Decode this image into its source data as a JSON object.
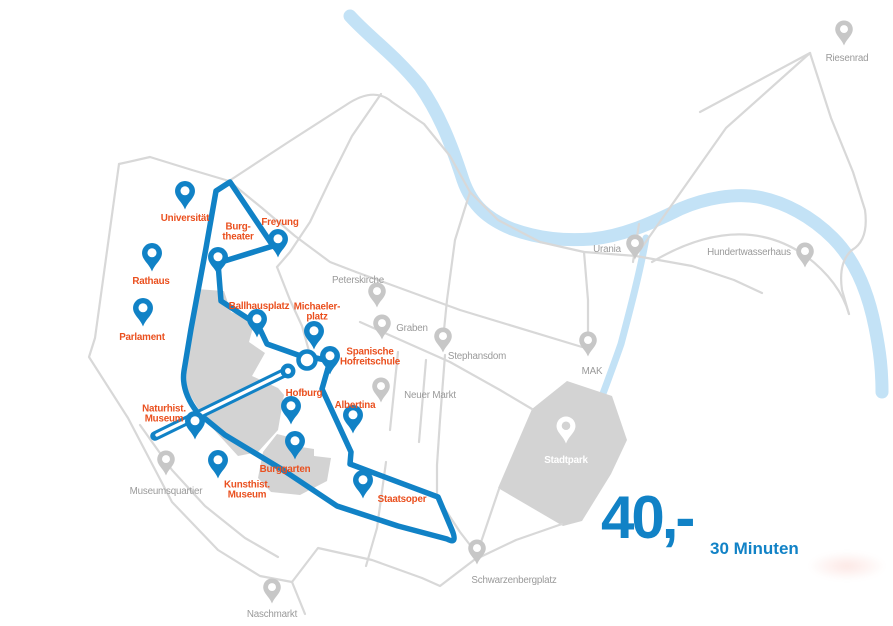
{
  "map": {
    "price": {
      "amount": "40,-",
      "duration": "30 Minuten"
    },
    "colors": {
      "route": "#1182c6",
      "tour_label": "#ea501f",
      "poi_label": "#9a9a9a",
      "road": "#d8d8d8",
      "river": "#c3e2f6",
      "area": "#d3d3d3",
      "pin_blue": "#1182c6",
      "pin_gray": "#c7c7c7"
    },
    "tour_stops": [
      {
        "id": "universitaet",
        "label": "Universität",
        "x": 185,
        "y": 210,
        "lx": 185,
        "ly": 219
      },
      {
        "id": "rathaus",
        "label": "Rathaus",
        "x": 152,
        "y": 272,
        "lx": 151,
        "ly": 282
      },
      {
        "id": "parlament",
        "label": "Parlament",
        "x": 143,
        "y": 327,
        "lx": 142,
        "ly": 338
      },
      {
        "id": "burgtheater",
        "label": "Burg-\ntheater",
        "x": 218,
        "y": 276,
        "lx": 238,
        "ly": 233
      },
      {
        "id": "freyung",
        "label": "Freyung",
        "x": 278,
        "y": 258,
        "lx": 280,
        "ly": 223
      },
      {
        "id": "ballhausplatz",
        "label": "Ballhausplatz",
        "x": 257,
        "y": 338,
        "lx": 259,
        "ly": 307
      },
      {
        "id": "michaelerplatz",
        "label": "Michaeler-\nplatz",
        "x": 314,
        "y": 350,
        "lx": 317,
        "ly": 313
      },
      {
        "id": "spanische-hofreitschule",
        "label": "Spanische\nHofreitschule",
        "x": 330,
        "y": 375,
        "lx": 370,
        "ly": 358
      },
      {
        "id": "hofburg",
        "label": "Hofburg",
        "x": 291,
        "y": 425,
        "lx": 304,
        "ly": 394
      },
      {
        "id": "albertina",
        "label": "Albertina",
        "x": 353,
        "y": 434,
        "lx": 355,
        "ly": 406
      },
      {
        "id": "naturhist-museum",
        "label": "Naturhist.\nMuseum",
        "x": 195,
        "y": 440,
        "lx": 164,
        "ly": 415
      },
      {
        "id": "kunsthist-museum",
        "label": "Kunsthist.\nMuseum",
        "x": 218,
        "y": 479,
        "lx": 247,
        "ly": 491
      },
      {
        "id": "burggarten",
        "label": "Burggarten",
        "x": 295,
        "y": 460,
        "lx": 285,
        "ly": 470
      },
      {
        "id": "staatsoper",
        "label": "Staatsoper",
        "x": 363,
        "y": 499,
        "lx": 402,
        "ly": 500
      }
    ],
    "landmarks": [
      {
        "id": "riesenrad",
        "label": "Riesenrad",
        "x": 844,
        "y": 46,
        "lx": 847,
        "ly": 59
      },
      {
        "id": "urania",
        "label": "Urania",
        "x": 635,
        "y": 260,
        "lx": 607,
        "ly": 250
      },
      {
        "id": "hundertwasserhaus",
        "label": "Hundertwasserhaus",
        "x": 805,
        "y": 268,
        "lx": 749,
        "ly": 253
      },
      {
        "id": "peterskirche",
        "label": "Peterskirche",
        "x": 377,
        "y": 308,
        "lx": 358,
        "ly": 281
      },
      {
        "id": "graben",
        "label": "Graben",
        "x": 382,
        "y": 340,
        "lx": 412,
        "ly": 329
      },
      {
        "id": "stephansdom",
        "label": "Stephansdom",
        "x": 443,
        "y": 353,
        "lx": 477,
        "ly": 357
      },
      {
        "id": "neuer-markt",
        "label": "Neuer Markt",
        "x": 381,
        "y": 403,
        "lx": 430,
        "ly": 396
      },
      {
        "id": "mak",
        "label": "MAK",
        "x": 588,
        "y": 357,
        "lx": 592,
        "ly": 372
      },
      {
        "id": "museumsquartier",
        "label": "Museumsquartier",
        "x": 166,
        "y": 476,
        "lx": 166,
        "ly": 492
      },
      {
        "id": "schwarzenbergplatz",
        "label": "Schwarzenbergplatz",
        "x": 477,
        "y": 565,
        "lx": 514,
        "ly": 581
      },
      {
        "id": "naschmarkt",
        "label": "Naschmarkt",
        "x": 272,
        "y": 604,
        "lx": 272,
        "ly": 615
      }
    ],
    "parks": [
      {
        "id": "stadtpark",
        "label": "Stadtpark",
        "x": 566,
        "y": 444,
        "lx": 566,
        "ly": 461
      }
    ]
  }
}
